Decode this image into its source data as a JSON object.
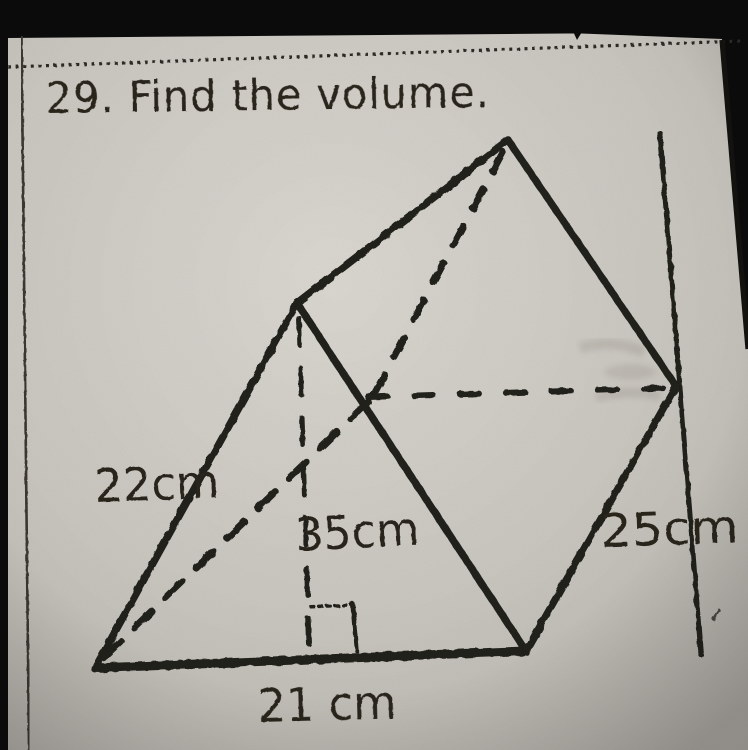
{
  "page": {
    "title_line": "29. Find the volume."
  },
  "figure": {
    "shape": "triangular prism",
    "labels": {
      "left_edge": "22cm",
      "altitude": "35cm",
      "right_edge": "25cm",
      "base": "21 cm"
    },
    "measurements": {
      "left_edge_cm": 22,
      "altitude_cm": 35,
      "right_edge_cm": 25,
      "base_cm": 21
    }
  },
  "colors": {
    "photo_background": "#0b0b0b",
    "paper": "#d3d0c9",
    "ink": "#26221b"
  }
}
